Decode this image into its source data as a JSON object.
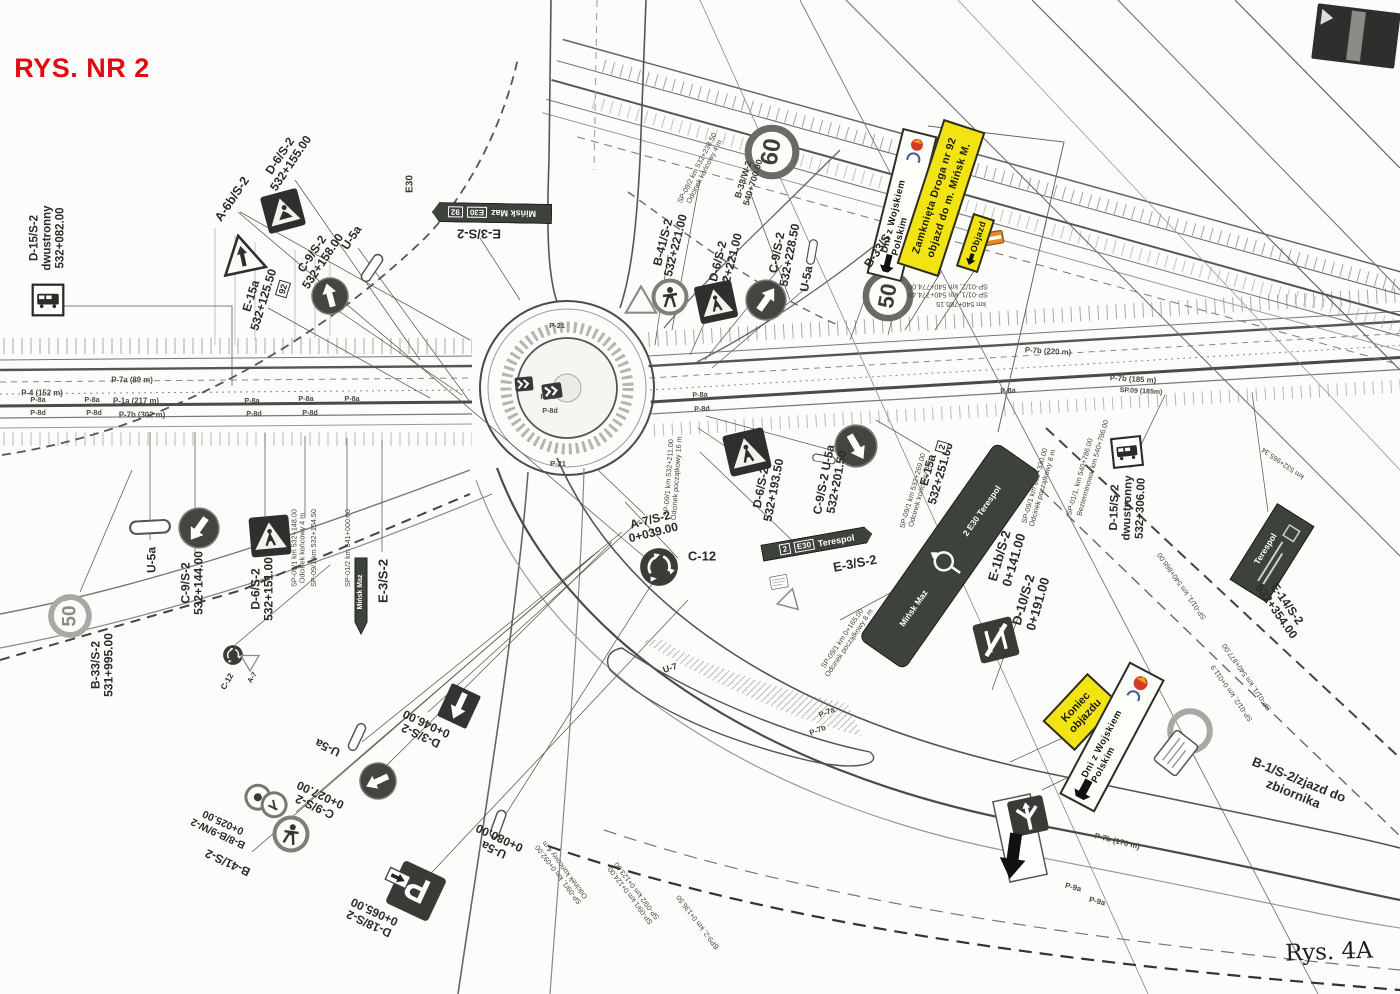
{
  "title": {
    "text": "RYS. NR 2",
    "color": "#e20a11"
  },
  "note": {
    "text": "Rys. 4A"
  },
  "colors": {
    "paper": "#fcfcfa",
    "ink": "#2b2b28",
    "yellow": "#f2e410",
    "red": "#e20a11",
    "board_dark": "#3d423c"
  },
  "boards": {
    "event_north": {
      "text": "Dni z Wojskiem Polskim"
    },
    "closure": {
      "line1": "Zamknięta Droga nr 92",
      "line2": "objazd do m. Mińsk M."
    },
    "objazd": {
      "text": "Objazd"
    },
    "koniec": {
      "line1": "Koniec",
      "line2": "objazdu"
    },
    "event_south": {
      "text": "Dni z Wojskiem Polskim"
    },
    "minsk_dir": {
      "route": "92",
      "euro": "E30",
      "dest": "Mińsk Maz"
    },
    "terespol_dir": {
      "route": "2",
      "euro": "E30",
      "dest": "Terespol"
    },
    "roundabout_dir": {
      "top": "2  E30  Terespol",
      "bottom": "Mińsk Maz"
    },
    "e14": {
      "dest": "Terespol"
    }
  },
  "annotations": [
    {
      "n": "drawing-title",
      "t": "RYS. NR 2",
      "x": 82,
      "y": 68,
      "r": 0,
      "s": 27,
      "c": "title"
    },
    {
      "n": "label-d15-nw",
      "t": "D-15/S-2\ndwustronny\n532+082.00",
      "x": 48,
      "y": 238,
      "r": -90,
      "s": 11.5
    },
    {
      "n": "label-a6b",
      "t": "A-6b/S-2",
      "x": 232,
      "y": 199,
      "r": -56,
      "s": 12.5
    },
    {
      "n": "label-d6-nw",
      "t": "D-6/S-2\n532+155.00",
      "x": 286,
      "y": 160,
      "r": -56,
      "s": 12
    },
    {
      "n": "label-c9-nw",
      "t": "C-9/S-2\n532+158.00",
      "x": 318,
      "y": 258,
      "r": -56,
      "s": 12
    },
    {
      "n": "label-u5a-nw",
      "t": "U-5a",
      "x": 352,
      "y": 238,
      "r": -56,
      "s": 12
    },
    {
      "n": "label-e15a-nw",
      "t": "E-15a\n532+125.50",
      "x": 258,
      "y": 298,
      "r": -73,
      "s": 12
    },
    {
      "n": "route-92-shield",
      "t": "92",
      "x": 283,
      "y": 289,
      "r": -73,
      "s": 9,
      "c": "box"
    },
    {
      "n": "label-e30",
      "t": "E30",
      "x": 410,
      "y": 184,
      "r": -90,
      "s": 10,
      "c": "fp2"
    },
    {
      "n": "label-e3-north",
      "t": "E-3/S-2",
      "x": 479,
      "y": 233,
      "r": 180,
      "s": 13
    },
    {
      "n": "label-b41-ne",
      "t": "B-41/S-2\n532+221.00",
      "x": 670,
      "y": 244,
      "r": -76,
      "s": 12
    },
    {
      "n": "label-d6-ne",
      "t": "D-6/S-2\n532+221.00",
      "x": 725,
      "y": 263,
      "r": -76,
      "s": 12
    },
    {
      "n": "label-b33w",
      "t": "B-33/W-2\n540+700.00",
      "x": 748,
      "y": 181,
      "r": -73,
      "s": 9,
      "c": "fp2"
    },
    {
      "n": "label-c9-ne",
      "t": "C-9/S-2\n532+228.50",
      "x": 784,
      "y": 254,
      "r": -79,
      "s": 12
    },
    {
      "n": "label-u5a-ne",
      "t": "U-5a",
      "x": 807,
      "y": 279,
      "r": -79,
      "s": 12
    },
    {
      "n": "label-b33s-ne",
      "t": "B-33/S",
      "x": 878,
      "y": 251,
      "r": -56,
      "s": 12
    },
    {
      "n": "speed-60",
      "t": "60",
      "x": 772,
      "y": 152,
      "r": -80,
      "s": 24,
      "c": "num"
    },
    {
      "n": "speed-50-ne",
      "t": "50",
      "x": 888,
      "y": 296,
      "r": -80,
      "s": 22,
      "c": "num"
    },
    {
      "n": "speed-50-sw",
      "t": "50",
      "x": 70,
      "y": 616,
      "r": -90,
      "s": 19,
      "c": "num2"
    },
    {
      "n": "label-b33s2-sw",
      "t": "B-33/S-2\n531+995.00",
      "x": 103,
      "y": 665,
      "r": -90,
      "s": 12
    },
    {
      "n": "label-u5a-w",
      "t": "U-5a",
      "x": 152,
      "y": 560,
      "r": -90,
      "s": 12
    },
    {
      "n": "label-c9-w",
      "t": "C-9/S-2\n532+144.00",
      "x": 193,
      "y": 583,
      "r": -90,
      "s": 12
    },
    {
      "n": "label-d6-w",
      "t": "D-6/S-2\n532+151.00",
      "x": 263,
      "y": 589,
      "r": -90,
      "s": 12
    },
    {
      "n": "label-e3-w",
      "t": "E-3/S-2",
      "x": 384,
      "y": 581,
      "r": -90,
      "s": 13
    },
    {
      "n": "label-minsk-maz-small",
      "t": "Mińsk Maz",
      "x": 361,
      "y": 592,
      "r": -90,
      "s": 7,
      "c": "fp2",
      "col": "#fff"
    },
    {
      "n": "label-c12-sm",
      "t": "C-12",
      "x": 228,
      "y": 682,
      "r": -60,
      "s": 8
    },
    {
      "n": "label-a7-sm",
      "t": "A-7",
      "x": 253,
      "y": 678,
      "r": -60,
      "s": 7
    },
    {
      "n": "label-a7s2",
      "t": "A-7/S-2\n0+039.00",
      "x": 652,
      "y": 527,
      "r": -14,
      "s": 12
    },
    {
      "n": "label-c12-big",
      "t": "C-12",
      "x": 702,
      "y": 557,
      "r": 0,
      "s": 13
    },
    {
      "n": "label-d6-mid",
      "t": "D-6/S-2\n532+193.50",
      "x": 768,
      "y": 489,
      "r": -79,
      "s": 12
    },
    {
      "n": "label-c9-u5a-mid",
      "t": "C-9/S-2  U-5a\n532+201.50",
      "x": 831,
      "y": 481,
      "r": -79,
      "s": 12
    },
    {
      "n": "label-e3-mid",
      "t": "E-3/S-2",
      "x": 855,
      "y": 564,
      "r": -11,
      "s": 13
    },
    {
      "n": "label-e15a-mid",
      "t": "E-15a\n532+251.00",
      "x": 935,
      "y": 472,
      "r": -74,
      "s": 12
    },
    {
      "n": "route-2-shield",
      "t": "2",
      "x": 942,
      "y": 447,
      "r": -74,
      "s": 9,
      "c": "box"
    },
    {
      "n": "label-e1b",
      "t": "E-1b/S-2\n0+141.00",
      "x": 1007,
      "y": 558,
      "r": -74,
      "s": 13
    },
    {
      "n": "label-d10",
      "t": "D-10/S-2\n0+191.00",
      "x": 1031,
      "y": 602,
      "r": -74,
      "s": 13
    },
    {
      "n": "label-d15-e",
      "t": "D-15/S-2\ndwustronny\n532+306.00",
      "x": 1128,
      "y": 508,
      "r": -88,
      "s": 11.5
    },
    {
      "n": "label-e14",
      "t": "E-14/S-2\n532+354.00",
      "x": 1281,
      "y": 608,
      "r": 55,
      "s": 12
    },
    {
      "n": "label-b1-zjazd",
      "t": "B-1/S-2/zjazd do zbiornika",
      "x": 1296,
      "y": 787,
      "r": 22,
      "s": 13
    },
    {
      "n": "label-d3s2",
      "t": "D-3/S-2\n0+046.00",
      "x": 424,
      "y": 729,
      "r": 205,
      "s": 12
    },
    {
      "n": "label-u5a-s1",
      "t": "U-5a",
      "x": 328,
      "y": 747,
      "r": 205,
      "s": 12
    },
    {
      "n": "label-c9-s",
      "t": "C-9/S-2\n0+027.00",
      "x": 318,
      "y": 800,
      "r": 205,
      "s": 12
    },
    {
      "n": "label-b8b9",
      "t": "B-8/B-9/W-2\n0+025.00",
      "x": 221,
      "y": 827,
      "r": 205,
      "s": 10.5
    },
    {
      "n": "label-b41-s",
      "t": "B-41/S-2",
      "x": 228,
      "y": 862,
      "r": 205,
      "s": 12
    },
    {
      "n": "label-u5a-s2",
      "t": "U-5a\n0+080.00",
      "x": 497,
      "y": 843,
      "r": 205,
      "s": 12
    },
    {
      "n": "label-d18",
      "t": "D-18/S-2\n0+065.00",
      "x": 372,
      "y": 917,
      "r": 205,
      "s": 12
    },
    {
      "n": "label-u7",
      "t": "U-7",
      "x": 670,
      "y": 668,
      "r": -18,
      "s": 9,
      "c": "fp2"
    },
    {
      "n": "handwritten-note",
      "t": "Rys. 4A",
      "x": 1329,
      "y": 953,
      "r": -2,
      "s": 23,
      "c": "hand"
    },
    {
      "n": "fp-sp092-ne",
      "t": "SP-09/2 km 532+238.50\nOdcinek końcowy 4 m",
      "x": 701,
      "y": 170,
      "r": -63,
      "s": 7.2,
      "c": "fp"
    },
    {
      "n": "fp-sp01-pair",
      "t": "SP-01/1, km 540+774.49\nSP-01/2, km 540+774.00",
      "x": 948,
      "y": 290,
      "r": 180,
      "s": 7.2,
      "c": "fp"
    },
    {
      "n": "fp-km785",
      "t": "km 540+785.15",
      "x": 961,
      "y": 304,
      "r": 180,
      "s": 7.2,
      "c": "fp"
    },
    {
      "n": "fp-sp154",
      "t": "SP-09/1 km 532+154.50",
      "x": 314,
      "y": 548,
      "r": -90,
      "s": 7.2,
      "c": "fp"
    },
    {
      "n": "fp-sp148",
      "t": "SP-09/1 km 532+148.00\nOdcinek końcowy 4 m",
      "x": 299,
      "y": 548,
      "r": -90,
      "s": 7.2,
      "c": "fp"
    },
    {
      "n": "fp-sp541",
      "t": "SP-01/2 km 541+000.00",
      "x": 348,
      "y": 548,
      "r": -90,
      "s": 7.2,
      "c": "fp"
    },
    {
      "n": "fp-sp211",
      "t": "SP-09/1 km 532+211.00\nOdcinek początkowy 16 m",
      "x": 673,
      "y": 478,
      "r": -86,
      "s": 7.2,
      "c": "fp"
    },
    {
      "n": "fp-sp269",
      "t": "SP-09/1 km 532+269.00\nOdcinek końcowy 4 m",
      "x": 917,
      "y": 492,
      "r": -74,
      "s": 7.2,
      "c": "fp"
    },
    {
      "n": "fp-sp330",
      "t": "SP-09/1 km 532+330.00\nOdcinek początkowy 8 m",
      "x": 1039,
      "y": 487,
      "r": -74,
      "s": 7.2,
      "c": "fp"
    },
    {
      "n": "fp-sp786",
      "t": "SP-01/1, km 540+786.00",
      "x": 1080,
      "y": 477,
      "r": -74,
      "s": 7.2,
      "c": "fp"
    },
    {
      "n": "fp-bez786",
      "t": "Bezterminowa, km 540+786.00",
      "x": 1093,
      "y": 468,
      "r": -74,
      "s": 7.2,
      "c": "fp"
    },
    {
      "n": "fp-sp165",
      "t": "SP-09/1 km 0+165.00\nOdcinek początkowy 8 m",
      "x": 846,
      "y": 641,
      "r": -56,
      "s": 7.2,
      "c": "fp"
    },
    {
      "n": "fp-sp092-s",
      "t": "SP-09/1, km 0+092.00\nOdcinek końcowy 4 m",
      "x": 562,
      "y": 872,
      "r": 233,
      "s": 7.2,
      "c": "fp"
    },
    {
      "n": "fp-sp124",
      "t": "SP-09/1 km 0+124.00\nSP-09/2 km 0+123.00",
      "x": 634,
      "y": 893,
      "r": 233,
      "s": 7.2,
      "c": "fp"
    },
    {
      "n": "fp-bp92",
      "t": "BP9-2, km 0+136.50",
      "x": 698,
      "y": 922,
      "r": 233,
      "s": 7.2,
      "c": "fp"
    },
    {
      "n": "fp-km965",
      "t": "km 532+965.34",
      "x": 1283,
      "y": 463,
      "r": 215,
      "s": 7.2,
      "c": "fp"
    },
    {
      "n": "fp-sp877",
      "t": "SP-01/1, km 540+877.00",
      "x": 1247,
      "y": 677,
      "r": 235,
      "s": 7.2,
      "c": "fp"
    },
    {
      "n": "fp-sp0119",
      "t": "SP-01/2, km 0+011.9",
      "x": 1232,
      "y": 693,
      "r": 235,
      "s": 7.2,
      "c": "fp"
    },
    {
      "n": "fp-sp866",
      "t": "SP-01/1, km 540+866.00",
      "x": 1182,
      "y": 586,
      "r": 235,
      "s": 7.2,
      "c": "fp"
    },
    {
      "n": "mark-p7a-89",
      "t": "P-7a (89 m)",
      "x": 132,
      "y": 381,
      "r": 0,
      "s": 7.8,
      "c": "mk"
    },
    {
      "n": "mark-p4",
      "t": "P-4 (152 m)",
      "x": 42,
      "y": 394,
      "r": 0,
      "s": 7.8,
      "c": "mk"
    },
    {
      "n": "mark-p1a",
      "t": "P-1a (217 m)",
      "x": 136,
      "y": 402,
      "r": 0,
      "s": 7.8,
      "c": "mk"
    },
    {
      "n": "mark-p7b-302",
      "t": "P-7b (302 m)",
      "x": 142,
      "y": 416,
      "r": 0,
      "s": 7.8,
      "c": "mk"
    },
    {
      "n": "mark-p7b-220",
      "t": "P-7b (220 m)",
      "x": 1048,
      "y": 352,
      "r": 3,
      "s": 7.8,
      "c": "mk"
    },
    {
      "n": "mark-p7b-185",
      "t": "P-7b (185 m)",
      "x": 1133,
      "y": 380,
      "r": 3,
      "s": 7.8,
      "c": "mk"
    },
    {
      "n": "mark-sp09-185",
      "t": "SP.09 (185m)",
      "x": 1141,
      "y": 392,
      "r": 3,
      "s": 7,
      "c": "mk"
    },
    {
      "n": "mark-p7a-ramp",
      "t": "P-7a",
      "x": 827,
      "y": 713,
      "r": -22,
      "s": 7.8,
      "c": "mk"
    },
    {
      "n": "mark-p7b-ramp",
      "t": "P-7b",
      "x": 818,
      "y": 731,
      "r": -22,
      "s": 7.8,
      "c": "mk"
    },
    {
      "n": "mark-p7b-170",
      "t": "P-7b (170 m)",
      "x": 1117,
      "y": 842,
      "r": 14,
      "s": 7.8,
      "c": "mk"
    },
    {
      "n": "mark-p9a-1",
      "t": "P-9a",
      "x": 1073,
      "y": 888,
      "r": 14,
      "s": 7.8,
      "c": "mk"
    },
    {
      "n": "mark-p9a-2",
      "t": "P-9a",
      "x": 1097,
      "y": 902,
      "r": 14,
      "s": 7.8,
      "c": "mk"
    },
    {
      "n": "mark-p21-a",
      "t": "P-21",
      "x": 557,
      "y": 326,
      "r": 0,
      "s": 7.5,
      "c": "mk"
    },
    {
      "n": "mark-p21-b",
      "t": "P-21",
      "x": 558,
      "y": 464,
      "r": 0,
      "s": 7.5,
      "c": "mk"
    },
    {
      "n": "mark-p8a-1",
      "t": "P-8a",
      "x": 38,
      "y": 400,
      "r": 0,
      "s": 7.2,
      "c": "mk"
    },
    {
      "n": "mark-p8a-2",
      "t": "P-8a",
      "x": 92,
      "y": 400,
      "r": 0,
      "s": 7.2,
      "c": "mk"
    },
    {
      "n": "mark-p8a-3",
      "t": "P-8a",
      "x": 252,
      "y": 401,
      "r": 0,
      "s": 7.2,
      "c": "mk"
    },
    {
      "n": "mark-p8a-4",
      "t": "P-8a",
      "x": 306,
      "y": 399,
      "r": 0,
      "s": 7.2,
      "c": "mk"
    },
    {
      "n": "mark-p8a-5",
      "t": "P-8a",
      "x": 352,
      "y": 399,
      "r": 0,
      "s": 7.2,
      "c": "mk"
    },
    {
      "n": "mark-p8a-6",
      "t": "P-8a",
      "x": 548,
      "y": 397,
      "r": 0,
      "s": 7.2,
      "c": "mk"
    },
    {
      "n": "mark-p8a-7",
      "t": "P-8a",
      "x": 700,
      "y": 395,
      "r": -3,
      "s": 7.2,
      "c": "mk"
    },
    {
      "n": "mark-p8a-8",
      "t": "P-8a",
      "x": 1008,
      "y": 391,
      "r": -3,
      "s": 7.2,
      "c": "mk"
    },
    {
      "n": "mark-p8d-1",
      "t": "P-8d",
      "x": 38,
      "y": 413,
      "r": 0,
      "s": 7.2,
      "c": "mk"
    },
    {
      "n": "mark-p8d-2",
      "t": "P-8d",
      "x": 94,
      "y": 413,
      "r": 0,
      "s": 7.2,
      "c": "mk"
    },
    {
      "n": "mark-p8d-3",
      "t": "P-8d",
      "x": 254,
      "y": 414,
      "r": 0,
      "s": 7.2,
      "c": "mk"
    },
    {
      "n": "mark-p8d-4",
      "t": "P-8d",
      "x": 310,
      "y": 413,
      "r": 0,
      "s": 7.2,
      "c": "mk"
    },
    {
      "n": "mark-p8d-5",
      "t": "P-8d",
      "x": 550,
      "y": 411,
      "r": 0,
      "s": 7.2,
      "c": "mk"
    },
    {
      "n": "mark-p8d-6",
      "t": "P-8d",
      "x": 702,
      "y": 409,
      "r": -3,
      "s": 7.2,
      "c": "mk"
    }
  ],
  "icons": [
    {
      "n": "bus-stop-sign-icon",
      "k": "bus",
      "x": 48,
      "y": 300,
      "r": 0,
      "sz": 36
    },
    {
      "n": "roadworks-sign-icon",
      "k": "works",
      "x": 283,
      "y": 211,
      "r": -15,
      "sz": 40
    },
    {
      "n": "side-road-sign-icon",
      "k": "a6b",
      "x": 242,
      "y": 254,
      "r": -12,
      "sz": 46
    },
    {
      "n": "c9-circle-icon",
      "k": "c9",
      "x": 330,
      "y": 296,
      "r": -15,
      "sz": 40
    },
    {
      "n": "u5a-pill-icon",
      "k": "u5a",
      "x": 372,
      "y": 268,
      "r": -56,
      "sz": 32
    },
    {
      "n": "yield-outline-icon",
      "k": "tri",
      "x": 641,
      "y": 300,
      "r": 0,
      "sz": 34
    },
    {
      "n": "no-pedestrians-icon",
      "k": "noped",
      "x": 670,
      "y": 297,
      "r": 0,
      "sz": 40
    },
    {
      "n": "crosswalk-sign-icon",
      "k": "cross",
      "x": 716,
      "y": 302,
      "r": -12,
      "sz": 40
    },
    {
      "n": "c9-circle-icon",
      "k": "c9",
      "x": 766,
      "y": 300,
      "r": 35,
      "sz": 44
    },
    {
      "n": "u5a-pill-icon",
      "k": "u5a",
      "x": 812,
      "y": 252,
      "r": -80,
      "sz": 26
    },
    {
      "n": "speed-ring-icon",
      "k": "ring",
      "x": 772,
      "y": 152,
      "r": 0,
      "sz": 56
    },
    {
      "n": "speed-ring-icon",
      "k": "ring",
      "x": 888,
      "y": 296,
      "r": 0,
      "sz": 52
    },
    {
      "n": "speed-ring-gray-icon",
      "k": "ringgray",
      "x": 70,
      "y": 616,
      "r": 0,
      "sz": 46
    },
    {
      "n": "barrier-box-icon",
      "k": "barrier",
      "x": 994,
      "y": 238,
      "r": -10,
      "sz": 20
    },
    {
      "n": "u5a-pill-icon",
      "k": "u5a",
      "x": 150,
      "y": 527,
      "r": -3,
      "sz": 42
    },
    {
      "n": "c9-circle-icon",
      "k": "c9",
      "x": 199,
      "y": 528,
      "r": 215,
      "sz": 44
    },
    {
      "n": "crosswalk-sign-icon",
      "k": "cross",
      "x": 270,
      "y": 536,
      "r": -5,
      "sz": 42
    },
    {
      "n": "direction-board-small-icon",
      "k": "dirsmall",
      "x": 361,
      "y": 596,
      "r": 0,
      "sz": 16
    },
    {
      "n": "c12-circle-icon",
      "k": "c12",
      "x": 233,
      "y": 655,
      "r": 0,
      "sz": 22
    },
    {
      "n": "yield-outline-icon",
      "k": "tri",
      "x": 250,
      "y": 663,
      "r": 180,
      "sz": 20
    },
    {
      "n": "c12-circle-icon",
      "k": "c12",
      "x": 659,
      "y": 567,
      "r": 0,
      "sz": 42
    },
    {
      "n": "crosswalk-sign-icon",
      "k": "cross",
      "x": 747,
      "y": 452,
      "r": -13,
      "sz": 44
    },
    {
      "n": "c9-circle-icon",
      "k": "c9",
      "x": 856,
      "y": 446,
      "r": 150,
      "sz": 46
    },
    {
      "n": "u5a-pill-icon",
      "k": "u5a",
      "x": 824,
      "y": 459,
      "r": 10,
      "sz": 24
    },
    {
      "n": "plaque-icon",
      "k": "plaque",
      "x": 779,
      "y": 582,
      "r": -10,
      "sz": 18
    },
    {
      "n": "yield-outline-icon",
      "k": "tri",
      "x": 790,
      "y": 598,
      "r": 15,
      "sz": 24
    },
    {
      "n": "chevron-board-icon",
      "k": "chev",
      "x": 524,
      "y": 384,
      "r": -5,
      "sz": 20
    },
    {
      "n": "chevron-board-icon",
      "k": "chev",
      "x": 552,
      "y": 391,
      "r": -8,
      "sz": 22
    },
    {
      "n": "d10-sign-icon",
      "k": "d10",
      "x": 996,
      "y": 640,
      "r": -14,
      "sz": 44
    },
    {
      "n": "bus-stop-sign-icon",
      "k": "bus",
      "x": 1127,
      "y": 452,
      "r": -6,
      "sz": 34
    },
    {
      "n": "ghost-ring-icon",
      "k": "ringgray",
      "x": 1190,
      "y": 731,
      "r": 0,
      "sz": 48
    },
    {
      "n": "plaque-icon",
      "k": "plaque",
      "x": 1176,
      "y": 753,
      "r": -52,
      "sz": 40
    },
    {
      "n": "white-plate-icon",
      "k": "wplate",
      "x": 1020,
      "y": 838,
      "r": -12,
      "sz": 40
    },
    {
      "n": "junction-sign-icon",
      "k": "junction",
      "x": 1028,
      "y": 816,
      "r": -12,
      "sz": 40
    },
    {
      "n": "big-arrow-icon",
      "k": "bigarrow",
      "x": 1013,
      "y": 856,
      "r": 8,
      "sz": 30
    },
    {
      "n": "one-way-sign-icon",
      "k": "oneway",
      "x": 459,
      "y": 706,
      "r": 205,
      "sz": 40
    },
    {
      "n": "u5a-pill-icon",
      "k": "u5a",
      "x": 357,
      "y": 737,
      "r": 115,
      "sz": 30
    },
    {
      "n": "c9-circle-icon",
      "k": "c9",
      "x": 378,
      "y": 781,
      "r": 245,
      "sz": 40
    },
    {
      "n": "two-circles-icon",
      "k": "twocirc",
      "x": 266,
      "y": 801,
      "r": 25,
      "sz": 46
    },
    {
      "n": "no-pedestrians-icon",
      "k": "noped",
      "x": 291,
      "y": 834,
      "r": 15,
      "sz": 40
    },
    {
      "n": "u5a-pill-icon",
      "k": "u5a",
      "x": 498,
      "y": 824,
      "r": 110,
      "sz": 30
    },
    {
      "n": "parking-sign-icon",
      "k": "parking",
      "x": 416,
      "y": 891,
      "r": 205,
      "sz": 52
    },
    {
      "n": "arrow-plate-icon",
      "k": "arrowplate",
      "x": 398,
      "y": 878,
      "r": 205,
      "sz": 24
    },
    {
      "n": "dark-board-icon",
      "k": "darkboard",
      "x": 1356,
      "y": 36,
      "r": 7,
      "sz": 86
    }
  ]
}
